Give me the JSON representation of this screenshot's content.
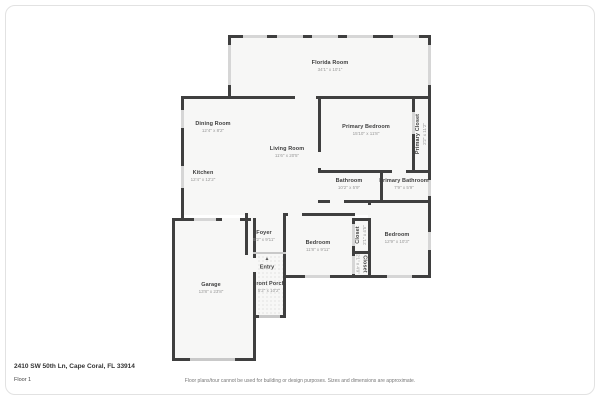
{
  "page": {
    "address": "2410 SW 50th Ln, Cape Coral, FL 33914",
    "floor_label": "Floor 1",
    "disclaimer": "Floor plans/tour cannot be used for building or design purposes. Sizes and dimensions are approximate."
  },
  "colors": {
    "wall": "#3f3f3f",
    "window": "#d6d6d6",
    "floor": "#f7f7f6",
    "room_name_text": "#3f3f3f",
    "room_dims_text": "#979797"
  },
  "rooms": {
    "florida_room": {
      "name": "Florida Room",
      "dims": "34'1\" x 10'1\""
    },
    "dining_room": {
      "name": "Dining Room",
      "dims": "12'4\" x 8'2\""
    },
    "living_room": {
      "name": "Living Room",
      "dims": "11'6\" x 20'5\""
    },
    "kitchen": {
      "name": "Kitchen",
      "dims": "12'4\" x 12'2\""
    },
    "primary_bedroom": {
      "name": "Primary Bedroom",
      "dims": "15'10\" x 11'8\""
    },
    "primary_closet": {
      "name": "Primary Closet",
      "dims": "2'2\" x 11'2\""
    },
    "bathroom": {
      "name": "Bathroom",
      "dims": "10'2\" x 5'9\""
    },
    "primary_bathroom": {
      "name": "Primary Bathroom",
      "dims": "7'9\" x 5'9\""
    },
    "foyer": {
      "name": "Foyer",
      "dims": "5'2\" x 9'11\""
    },
    "bedroom_center": {
      "name": "Bedroom",
      "dims": "11'8\" x 9'11\""
    },
    "closet_top": {
      "name": "Closet",
      "dims": "2'1\" x 4'5\""
    },
    "closet_bottom": {
      "name": "Closet",
      "dims": "2'1\" x 4'9\""
    },
    "bedroom_right": {
      "name": "Bedroom",
      "dims": "12'9\" x 10'3\""
    },
    "entry": {
      "name": "Entry"
    },
    "front_porch": {
      "name": "Front Porch",
      "dims": "5'2\" x 10'2\""
    },
    "garage": {
      "name": "Garage",
      "dims": "13'8\" x 23'8\""
    }
  },
  "icons": {
    "entry_arrow": "▲"
  }
}
